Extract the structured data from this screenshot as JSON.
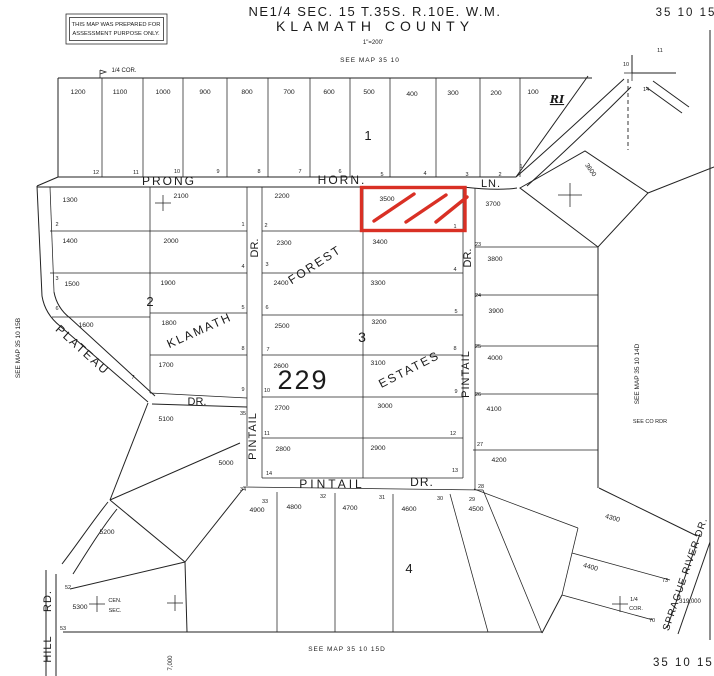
{
  "header": {
    "title_line1": "NE1/4 SEC. 15 T.35S. R.10E. W.M.",
    "title_line2": "KLAMATH COUNTY",
    "scale": "1\"=200'",
    "sheet_number_top": "35 10 15",
    "sheet_number_bottom": "35 10 15.",
    "disclaimer_line1": "THIS MAP WAS PREPARED FOR",
    "disclaimer_line2": "ASSESSMENT PURPOSE ONLY."
  },
  "colors": {
    "ink": "#1c1c1c",
    "highlight": "#d93025",
    "paper": "#ffffff"
  },
  "highlighted_parcel": {
    "number": "3500"
  },
  "map": {
    "labels": [
      {
        "t": "SEE MAP 35 10",
        "x": 370,
        "y": 62,
        "s": 6.5,
        "ls": 1
      },
      {
        "t": "1/4 COR.",
        "x": 124,
        "y": 72,
        "s": 6
      },
      {
        "t": "SEE MAP 35 10 15B",
        "x": 20,
        "y": 348,
        "s": 6.5,
        "r": -90
      },
      {
        "t": "SEE MAP 35 10 14D",
        "x": 639,
        "y": 374,
        "s": 6.5,
        "r": -90
      },
      {
        "t": "SEE CO RDR",
        "x": 650,
        "y": 423,
        "s": 5.5
      },
      {
        "t": "SEE MAP 35 10 15D",
        "x": 347,
        "y": 651,
        "s": 6.5,
        "ls": 1
      },
      {
        "t": "7,000",
        "x": 172,
        "y": 663,
        "s": 6,
        "r": -90
      },
      {
        "t": "319,000",
        "x": 690,
        "y": 603,
        "s": 6
      },
      {
        "t": "1/4",
        "x": 634,
        "y": 601,
        "s": 5.5
      },
      {
        "t": "COR.",
        "x": 636,
        "y": 610,
        "s": 5.5
      },
      {
        "t": "CEN.",
        "x": 115,
        "y": 602,
        "s": 5.5
      },
      {
        "t": "SEC.",
        "x": 115,
        "y": 612,
        "s": 5.5
      },
      {
        "t": "RI",
        "x": 557,
        "y": 103,
        "s": 11,
        "c": "ri"
      },
      {
        "t": "10",
        "x": 626,
        "y": 66,
        "s": 5.5
      },
      {
        "t": "11",
        "x": 660,
        "y": 52,
        "s": 5.5
      },
      {
        "t": "14",
        "x": 646,
        "y": 91,
        "s": 5.5
      },
      {
        "t": "PRONG",
        "x": 169,
        "y": 185,
        "s": 12,
        "ls": 2
      },
      {
        "t": "HORN.",
        "x": 342,
        "y": 184,
        "s": 12,
        "ls": 2
      },
      {
        "t": "LN.",
        "x": 491,
        "y": 187,
        "s": 11,
        "ls": 1
      },
      {
        "t": "KLAMATH",
        "x": 201,
        "y": 334,
        "s": 12,
        "r": -24,
        "ls": 2
      },
      {
        "t": "DR.",
        "x": 258,
        "y": 248,
        "s": 11,
        "r": -90
      },
      {
        "t": "PINTAIL",
        "x": 256,
        "y": 436,
        "s": 11,
        "r": -90,
        "ls": 1
      },
      {
        "t": "FOREST",
        "x": 317,
        "y": 268,
        "s": 12,
        "r": -33,
        "ls": 2
      },
      {
        "t": "ESTATES",
        "x": 411,
        "y": 373,
        "s": 12,
        "r": -27,
        "ls": 2
      },
      {
        "t": "DR.",
        "x": 471,
        "y": 258,
        "s": 11,
        "r": -90
      },
      {
        "t": "PINTAIL",
        "x": 469,
        "y": 374,
        "s": 11,
        "r": -90,
        "ls": 1
      },
      {
        "t": "PINTAIL",
        "x": 332,
        "y": 488,
        "s": 12,
        "ls": 3
      },
      {
        "t": "DR.",
        "x": 422,
        "y": 486,
        "s": 12,
        "ls": 1
      },
      {
        "t": "PLATEAU",
        "x": 80,
        "y": 353,
        "s": 12,
        "r": 42,
        "ls": 2
      },
      {
        "t": "DR.",
        "x": 197,
        "y": 405,
        "s": 11
      },
      {
        "t": "HILL",
        "x": 51,
        "y": 649,
        "s": 11,
        "r": -90,
        "ls": 1
      },
      {
        "t": "RD.",
        "x": 51,
        "y": 601,
        "s": 11,
        "r": -90,
        "ls": 1
      },
      {
        "t": "SPRAGUE RIVER DR.",
        "x": 688,
        "y": 575,
        "s": 10,
        "r": -71,
        "ls": 1
      },
      {
        "t": "3600",
        "x": 589,
        "y": 171,
        "s": 6.5,
        "r": 55
      },
      {
        "t": "1",
        "x": 368,
        "y": 140,
        "s": 13
      },
      {
        "t": "2",
        "x": 150,
        "y": 306,
        "s": 13
      },
      {
        "t": "3",
        "x": 362,
        "y": 342,
        "s": 14
      },
      {
        "t": "4",
        "x": 409,
        "y": 573,
        "s": 13
      },
      {
        "t": "229",
        "x": 303,
        "y": 389,
        "s": 27,
        "ls": 2
      },
      {
        "t": "1200",
        "x": 78,
        "y": 94,
        "s": 6.8
      },
      {
        "t": "1100",
        "x": 120,
        "y": 94,
        "s": 6.8
      },
      {
        "t": "1000",
        "x": 163,
        "y": 94,
        "s": 6.8
      },
      {
        "t": "900",
        "x": 205,
        "y": 94,
        "s": 6.8
      },
      {
        "t": "800",
        "x": 247,
        "y": 94,
        "s": 6.8
      },
      {
        "t": "700",
        "x": 289,
        "y": 94,
        "s": 6.8
      },
      {
        "t": "600",
        "x": 329,
        "y": 94,
        "s": 6.8
      },
      {
        "t": "500",
        "x": 369,
        "y": 94,
        "s": 6.8
      },
      {
        "t": "400",
        "x": 412,
        "y": 96,
        "s": 6.8
      },
      {
        "t": "300",
        "x": 453,
        "y": 95,
        "s": 6.8
      },
      {
        "t": "200",
        "x": 496,
        "y": 95,
        "s": 6.8
      },
      {
        "t": "100",
        "x": 533,
        "y": 94,
        "s": 6.8
      },
      {
        "t": "1300",
        "x": 70,
        "y": 202,
        "s": 6.8
      },
      {
        "t": "1400",
        "x": 70,
        "y": 243,
        "s": 6.8
      },
      {
        "t": "1500",
        "x": 72,
        "y": 286,
        "s": 6.8
      },
      {
        "t": "1600",
        "x": 86,
        "y": 327,
        "s": 6.8
      },
      {
        "t": "2100",
        "x": 181,
        "y": 198,
        "s": 6.8
      },
      {
        "t": "2000",
        "x": 171,
        "y": 243,
        "s": 6.8
      },
      {
        "t": "1900",
        "x": 168,
        "y": 285,
        "s": 6.8
      },
      {
        "t": "1800",
        "x": 169,
        "y": 325,
        "s": 6.8
      },
      {
        "t": "1700",
        "x": 166,
        "y": 367,
        "s": 6.8
      },
      {
        "t": "2200",
        "x": 282,
        "y": 198,
        "s": 6.8
      },
      {
        "t": "2300",
        "x": 284,
        "y": 245,
        "s": 6.8
      },
      {
        "t": "2400",
        "x": 281,
        "y": 285,
        "s": 6.8
      },
      {
        "t": "2500",
        "x": 282,
        "y": 328,
        "s": 6.8
      },
      {
        "t": "2600",
        "x": 281,
        "y": 368,
        "s": 6.8
      },
      {
        "t": "2700",
        "x": 282,
        "y": 410,
        "s": 6.8
      },
      {
        "t": "2800",
        "x": 283,
        "y": 451,
        "s": 6.8
      },
      {
        "t": "3500",
        "x": 387,
        "y": 201,
        "s": 6.8
      },
      {
        "t": "3400",
        "x": 380,
        "y": 244,
        "s": 6.8
      },
      {
        "t": "3300",
        "x": 378,
        "y": 285,
        "s": 6.8
      },
      {
        "t": "3200",
        "x": 379,
        "y": 324,
        "s": 6.8
      },
      {
        "t": "3100",
        "x": 378,
        "y": 365,
        "s": 6.8
      },
      {
        "t": "3000",
        "x": 385,
        "y": 408,
        "s": 6.8
      },
      {
        "t": "2900",
        "x": 378,
        "y": 450,
        "s": 6.8
      },
      {
        "t": "3700",
        "x": 493,
        "y": 206,
        "s": 6.8
      },
      {
        "t": "3800",
        "x": 495,
        "y": 261,
        "s": 6.8
      },
      {
        "t": "3900",
        "x": 496,
        "y": 313,
        "s": 6.8
      },
      {
        "t": "4000",
        "x": 495,
        "y": 360,
        "s": 6.8
      },
      {
        "t": "4100",
        "x": 494,
        "y": 411,
        "s": 6.8
      },
      {
        "t": "4200",
        "x": 499,
        "y": 462,
        "s": 6.8
      },
      {
        "t": "4300",
        "x": 612,
        "y": 520,
        "s": 6.8,
        "r": 15
      },
      {
        "t": "4400",
        "x": 590,
        "y": 569,
        "s": 6.8,
        "r": 15
      },
      {
        "t": "4500",
        "x": 476,
        "y": 511,
        "s": 6.8
      },
      {
        "t": "4600",
        "x": 409,
        "y": 511,
        "s": 6.8
      },
      {
        "t": "4700",
        "x": 350,
        "y": 510,
        "s": 6.8
      },
      {
        "t": "4800",
        "x": 294,
        "y": 509,
        "s": 6.8
      },
      {
        "t": "4900",
        "x": 257,
        "y": 512,
        "s": 6.8
      },
      {
        "t": "5000",
        "x": 226,
        "y": 465,
        "s": 6.8
      },
      {
        "t": "5100",
        "x": 166,
        "y": 421,
        "s": 6.8
      },
      {
        "t": "5200",
        "x": 107,
        "y": 534,
        "s": 6.8
      },
      {
        "t": "5300",
        "x": 80,
        "y": 609,
        "s": 6.8
      },
      {
        "t": "12",
        "x": 96,
        "y": 174,
        "s": 5.5
      },
      {
        "t": "11",
        "x": 136,
        "y": 174,
        "s": 5.5
      },
      {
        "t": "10",
        "x": 177,
        "y": 173,
        "s": 5.5
      },
      {
        "t": "9",
        "x": 218,
        "y": 173,
        "s": 5.5
      },
      {
        "t": "8",
        "x": 259,
        "y": 173,
        "s": 5.5
      },
      {
        "t": "7",
        "x": 300,
        "y": 173,
        "s": 5.5
      },
      {
        "t": "6",
        "x": 340,
        "y": 173,
        "s": 5.5
      },
      {
        "t": "5",
        "x": 382,
        "y": 176,
        "s": 5.5
      },
      {
        "t": "4",
        "x": 425,
        "y": 175,
        "s": 5.5
      },
      {
        "t": "3",
        "x": 467,
        "y": 176,
        "s": 5.5
      },
      {
        "t": "2",
        "x": 500,
        "y": 176,
        "s": 5.5
      },
      {
        "t": "1",
        "x": 521,
        "y": 168,
        "s": 5.5
      },
      {
        "t": "2",
        "x": 57,
        "y": 226,
        "s": 5.5
      },
      {
        "t": "3",
        "x": 57,
        "y": 280,
        "s": 5.5
      },
      {
        "t": "6",
        "x": 57,
        "y": 310,
        "s": 5.5
      },
      {
        "t": "7",
        "x": 133,
        "y": 379,
        "s": 5.5
      },
      {
        "t": "1",
        "x": 243,
        "y": 226,
        "s": 5.5
      },
      {
        "t": "4",
        "x": 243,
        "y": 268,
        "s": 5.5
      },
      {
        "t": "5",
        "x": 243,
        "y": 309,
        "s": 5.5
      },
      {
        "t": "8",
        "x": 243,
        "y": 350,
        "s": 5.5
      },
      {
        "t": "9",
        "x": 243,
        "y": 391,
        "s": 5.5
      },
      {
        "t": "2",
        "x": 266,
        "y": 227,
        "s": 5.5
      },
      {
        "t": "3",
        "x": 267,
        "y": 266,
        "s": 5.5
      },
      {
        "t": "6",
        "x": 267,
        "y": 309,
        "s": 5.5
      },
      {
        "t": "7",
        "x": 268,
        "y": 351,
        "s": 5.5
      },
      {
        "t": "10",
        "x": 267,
        "y": 392,
        "s": 5.5
      },
      {
        "t": "11",
        "x": 267,
        "y": 435,
        "s": 5.5
      },
      {
        "t": "14",
        "x": 269,
        "y": 475,
        "s": 5.5
      },
      {
        "t": "1",
        "x": 455,
        "y": 228,
        "s": 5.5
      },
      {
        "t": "4",
        "x": 455,
        "y": 271,
        "s": 5.5
      },
      {
        "t": "5",
        "x": 456,
        "y": 313,
        "s": 5.5
      },
      {
        "t": "8",
        "x": 455,
        "y": 350,
        "s": 5.5
      },
      {
        "t": "9",
        "x": 456,
        "y": 393,
        "s": 5.5
      },
      {
        "t": "12",
        "x": 453,
        "y": 435,
        "s": 5.5
      },
      {
        "t": "13",
        "x": 455,
        "y": 472,
        "s": 5.5
      },
      {
        "t": "23",
        "x": 478,
        "y": 246,
        "s": 5.5
      },
      {
        "t": "24",
        "x": 478,
        "y": 297,
        "s": 5.5
      },
      {
        "t": "25",
        "x": 478,
        "y": 348,
        "s": 5.5
      },
      {
        "t": "26",
        "x": 478,
        "y": 396,
        "s": 5.5
      },
      {
        "t": "27",
        "x": 480,
        "y": 446,
        "s": 5.5
      },
      {
        "t": "28",
        "x": 481,
        "y": 488,
        "s": 5.5
      },
      {
        "t": "35",
        "x": 243,
        "y": 415,
        "s": 5.5
      },
      {
        "t": "34",
        "x": 243,
        "y": 491,
        "s": 5.5
      },
      {
        "t": "33",
        "x": 265,
        "y": 503,
        "s": 5.5
      },
      {
        "t": "32",
        "x": 323,
        "y": 498,
        "s": 5.5
      },
      {
        "t": "31",
        "x": 382,
        "y": 499,
        "s": 5.5
      },
      {
        "t": "30",
        "x": 440,
        "y": 500,
        "s": 5.5
      },
      {
        "t": "29",
        "x": 472,
        "y": 501,
        "s": 5.5
      },
      {
        "t": "52",
        "x": 68,
        "y": 589,
        "s": 5.5
      },
      {
        "t": "53",
        "x": 63,
        "y": 630,
        "s": 5.5
      },
      {
        "t": "70",
        "x": 652,
        "y": 622,
        "s": 5.5
      },
      {
        "t": "73",
        "x": 665,
        "y": 582,
        "s": 5.5
      }
    ]
  }
}
